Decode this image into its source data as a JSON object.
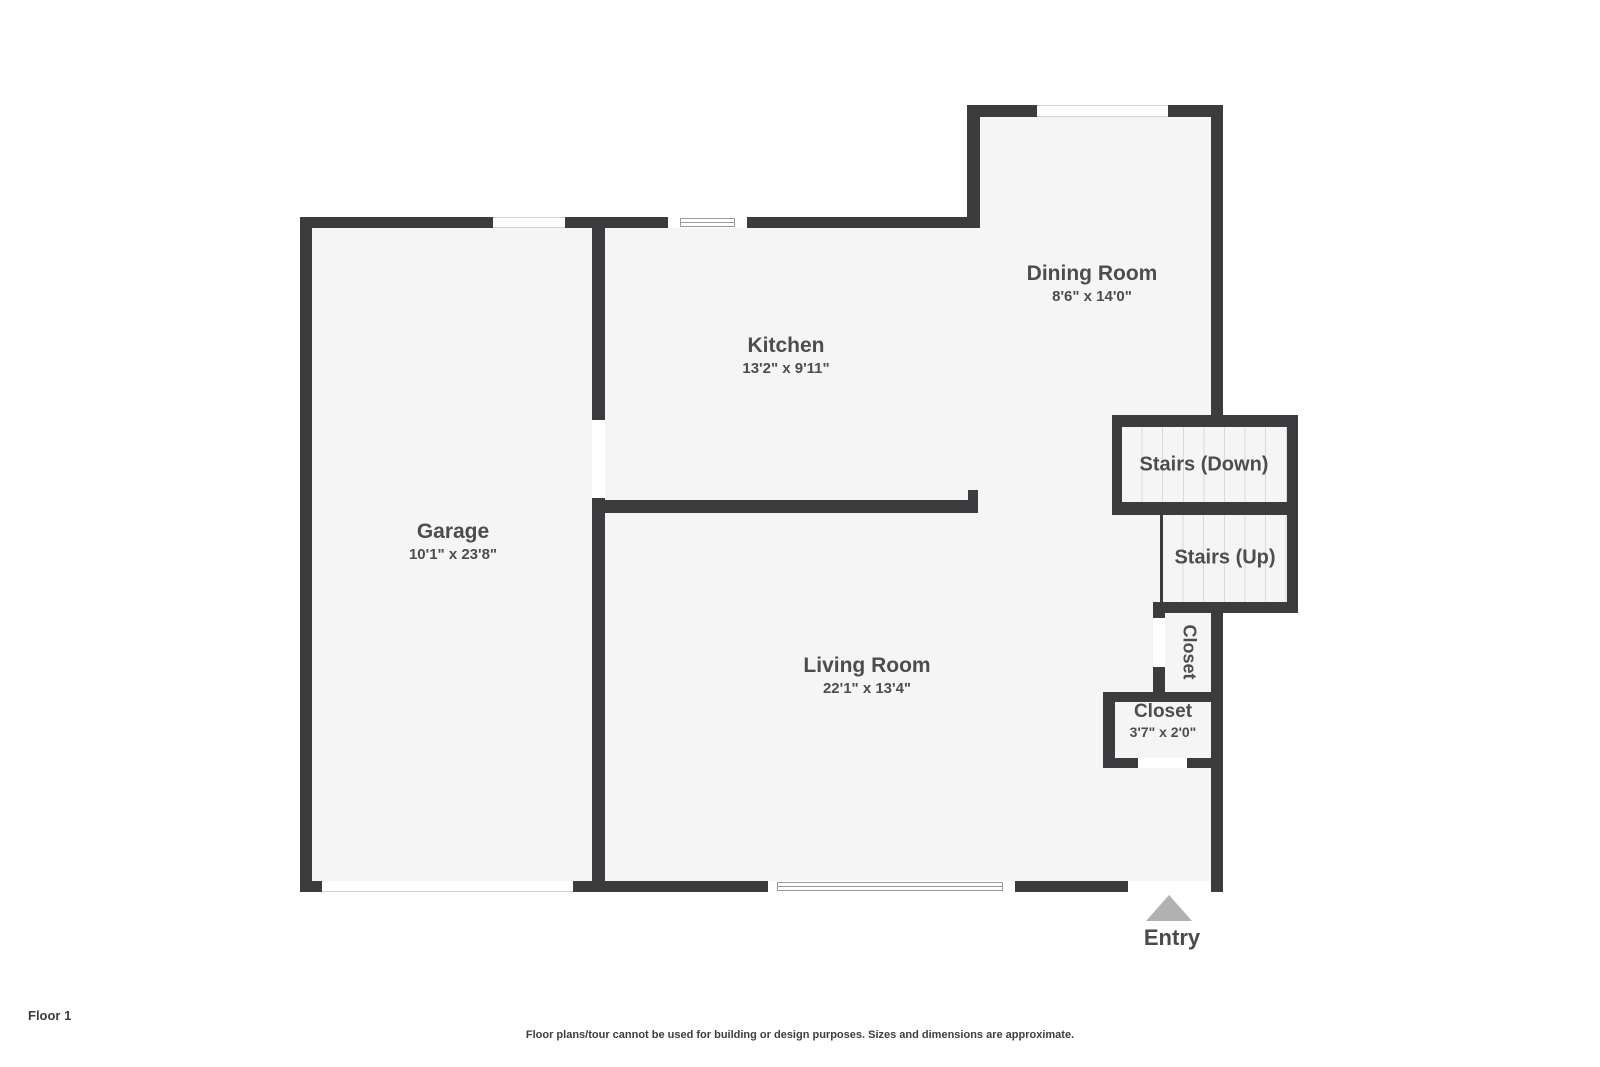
{
  "colors": {
    "wall": "#3c3c3f",
    "floor": "#f5f5f6",
    "background": "#ffffff",
    "tread_line": "#d9d9db",
    "window_line": "#9a9a9e",
    "label_text": "#4d4d4d",
    "entry_arrow": "#b1b1b4"
  },
  "rooms": {
    "garage": {
      "name": "Garage",
      "dims": "10'1\" x 23'8\""
    },
    "kitchen": {
      "name": "Kitchen",
      "dims": "13'2\" x 9'11\""
    },
    "dining": {
      "name": "Dining Room",
      "dims": "8'6\" x 14'0\""
    },
    "living": {
      "name": "Living Room",
      "dims": "22'1\" x 13'4\""
    },
    "stairs_down": {
      "name": "Stairs (Down)"
    },
    "stairs_up": {
      "name": "Stairs (Up)"
    },
    "closet_hall": {
      "name": "Closet"
    },
    "closet_entry": {
      "name": "Closet",
      "dims": "3'7\" x 2'0\""
    }
  },
  "entry": {
    "label": "Entry"
  },
  "footer": {
    "floor_label": "Floor 1",
    "disclaimer": "Floor plans/tour cannot be used for building or design purposes. Sizes and dimensions are approximate."
  }
}
